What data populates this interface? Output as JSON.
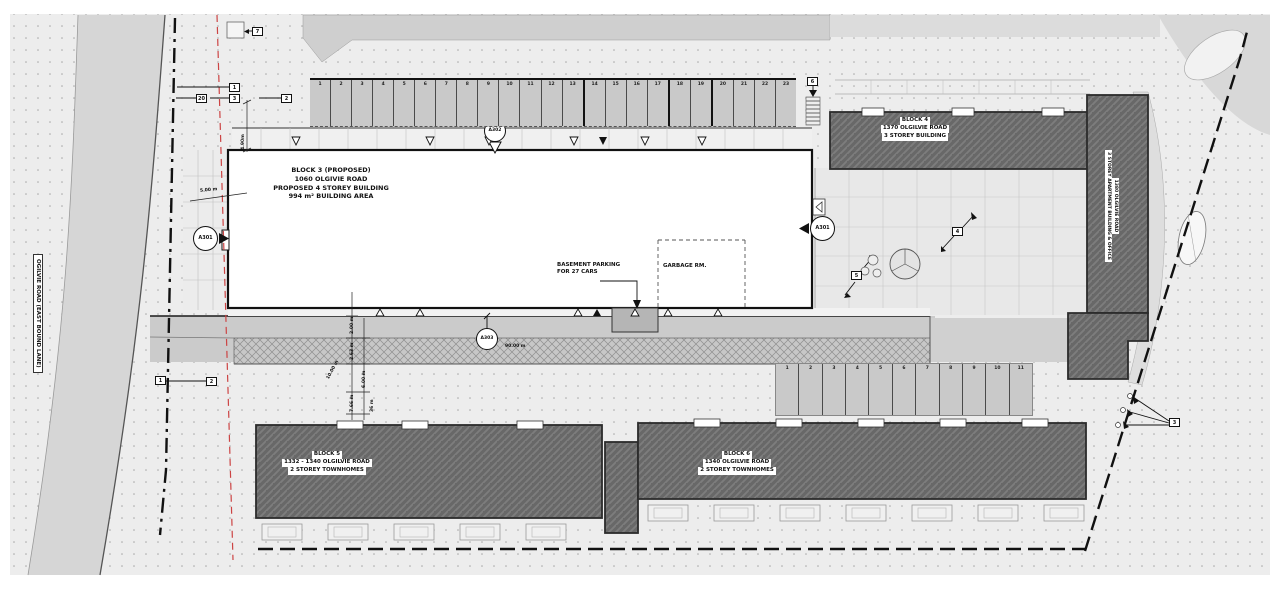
{
  "plan": {
    "street_label": "OGILVIE ROAD (EAST BOUND LANE)",
    "block3": {
      "line1": "BLOCK 3 (PROPOSED)",
      "line2": "1060 OLGIVIE ROAD",
      "line3": "PROPOSED 4 STOREY BUILDING",
      "line4": "994 m² BUILDING AREA"
    },
    "block4": {
      "line1": "BLOCK 4",
      "line2": "1370 OLGILVIE ROAD",
      "line3": "3 STOREY BUILDING"
    },
    "east_building": {
      "line1": "1380 OLGILVIE ROAD",
      "line2": "3 STOREY APARTMENT BUILDING & OFFICE"
    },
    "block5": {
      "line1": "BLOCK 5",
      "line2": "1332 - 1340 OLGILVIE ROAD",
      "line3": "2 STOREY TOWNHOMES"
    },
    "block6": {
      "line1": "BLOCK 6",
      "line2": "1340 OLGILVIE ROAD",
      "line3": "2 STOREY TOWNHOMES"
    },
    "notes": {
      "basement1": "BASEMENT PARKING",
      "basement2": "FOR 27 CARS",
      "garbage": "GARBAGE RM."
    },
    "section_markers": {
      "a301_left": "A301",
      "a301_right": "A301",
      "a302": "A302",
      "a303": "A303"
    },
    "dims": {
      "d490": "4.90m",
      "d500": "5.00 m",
      "d200": "2.00 m",
      "d263": "2.63 m",
      "d1000": "10.00 m",
      "d600": "6.00 m",
      "d766": "7.66 m",
      "d36": "36 m",
      "d90": "90.00 m"
    },
    "keynotes": {
      "k7": "7",
      "k1": "1",
      "k20": "20",
      "k3": "3",
      "k2": "2",
      "k6": "6",
      "k5": "5",
      "k4": "4",
      "kb3": "3",
      "ke1": "1",
      "ke2": "2"
    },
    "parking_top": [
      "1",
      "2",
      "3",
      "4",
      "5",
      "6",
      "7",
      "8",
      "9",
      "10",
      "11",
      "12",
      "13",
      "14",
      "15",
      "16",
      "17",
      "18",
      "19",
      "20",
      "21",
      "22",
      "23"
    ],
    "parking_bottom": [
      "1",
      "2",
      "3",
      "4",
      "5",
      "6",
      "7",
      "8",
      "9",
      "10",
      "11"
    ],
    "colors": {
      "paper": "#ffffff",
      "ground_dotted": "#ededed",
      "road": "#d6d6d6",
      "parking": "#c9c9c9",
      "building_dark": "#686868",
      "building_proposed": "#ffffff",
      "boundary_red": "#cc4444",
      "line": "#1a1a1a"
    }
  }
}
